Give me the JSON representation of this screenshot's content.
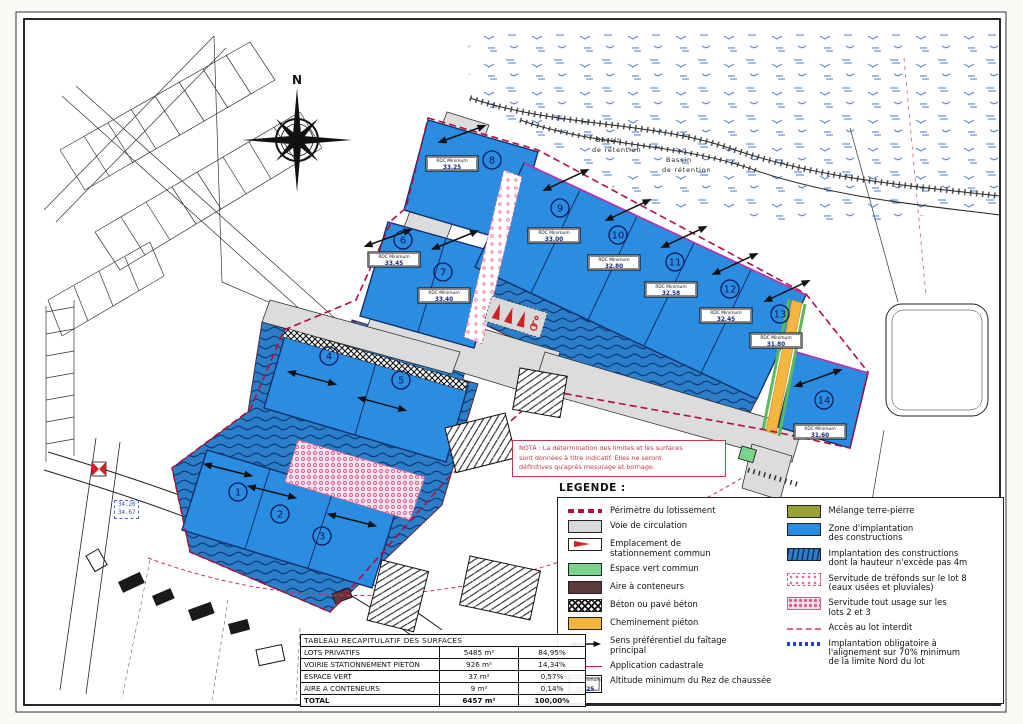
{
  "plan": {
    "compass_label": "N",
    "bassin_labels": [
      [
        "Bassin",
        "de rétention"
      ],
      [
        "Bassin",
        "de rétention"
      ]
    ],
    "rdc_label": "RDC  Minimum",
    "lots": [
      {
        "number": "1"
      },
      {
        "number": "2"
      },
      {
        "number": "3"
      },
      {
        "number": "4"
      },
      {
        "number": "5"
      },
      {
        "number": "6",
        "rdc": "33.45"
      },
      {
        "number": "7",
        "rdc": "33.40"
      },
      {
        "number": "8",
        "rdc": "33.25"
      },
      {
        "number": "9",
        "rdc": "33.00"
      },
      {
        "number": "10",
        "rdc": "32.80"
      },
      {
        "number": "11",
        "rdc": "32.58"
      },
      {
        "number": "12",
        "rdc": "32.45"
      },
      {
        "number": "13",
        "rdc": "31.80"
      },
      {
        "number": "14",
        "rdc": "31.60"
      }
    ],
    "spot_elevation": {
      "line1": "34.20",
      "line2": "34.67"
    },
    "nota": "NOTA : La détermination des limites et les surfaces\nsont données à titre indicatif. Elles ne seront\ndéfinitives qu'après mesurage et bornage."
  },
  "legend": {
    "title": "LEGENDE :",
    "left": [
      {
        "label": "Périmètre du lotissement"
      },
      {
        "label": "Voie de circulation"
      },
      {
        "label": "Emplacement de\nstationnement commun"
      },
      {
        "label": "Espace vert commun"
      },
      {
        "label": "Aire à conteneurs"
      },
      {
        "label": "Béton ou pavé béton"
      },
      {
        "label": "Cheminement piéton"
      },
      {
        "label": "Sens préférentiel du faîtage\nprincipal"
      },
      {
        "label": "Application cadastrale"
      },
      {
        "label": "Altitude minimum du Rez de chaussée"
      }
    ],
    "right": [
      {
        "label": "Mélange terre-pierre"
      },
      {
        "label": "Zone d'implantation\ndes constructions"
      },
      {
        "label": "Implantation des constructions\ndont la hauteur n'excède pas 4m"
      },
      {
        "label": "Servitude de tréfonds sur le lot 8\n(eaux usées et pluviales)"
      },
      {
        "label": "Servitude tout usage sur les\nlots 2 et 3"
      },
      {
        "label": "Accès au lot interdit"
      },
      {
        "label": "Implantation obligatoire à\nl'alignement sur 70% minimum\nde la limite Nord du lot"
      }
    ],
    "rdc_sample": {
      "label": "RDC  Minimum",
      "value": "33.25"
    }
  },
  "table": {
    "title": "TABLEAU RECAPITULATIF DES SURFACES",
    "rows": [
      {
        "label": "LOTS PRIVATIFS",
        "area": "5485 m²",
        "pct": "84,95%"
      },
      {
        "label": "VOIRIE STATIONNEMENT PIETON",
        "area": "926 m²",
        "pct": "14,34%"
      },
      {
        "label": "ESPACE VERT",
        "area": "37 m²",
        "pct": "0,57%"
      },
      {
        "label": "AIRE A CONTENEURS",
        "area": "9 m²",
        "pct": "0,14%"
      },
      {
        "label": "TOTAL",
        "area": "6457 m²",
        "pct": "100,00%"
      }
    ]
  },
  "colors": {
    "zone_blue": "#2b8de2",
    "zone_blue_hatch": "#2b7ec7",
    "road_gray": "#dcdcdc",
    "terre_pierre_olive": "#9aa134",
    "espace_vert_green": "#7bd389",
    "conteneurs_brown": "#5c3a3a",
    "cheminement_yellow": "#f4b63f",
    "servitude_pink": "#d06090",
    "perimeter_red": "#b2103c",
    "nota_red": "#c0394b",
    "bead_blue": "#2244cc"
  }
}
